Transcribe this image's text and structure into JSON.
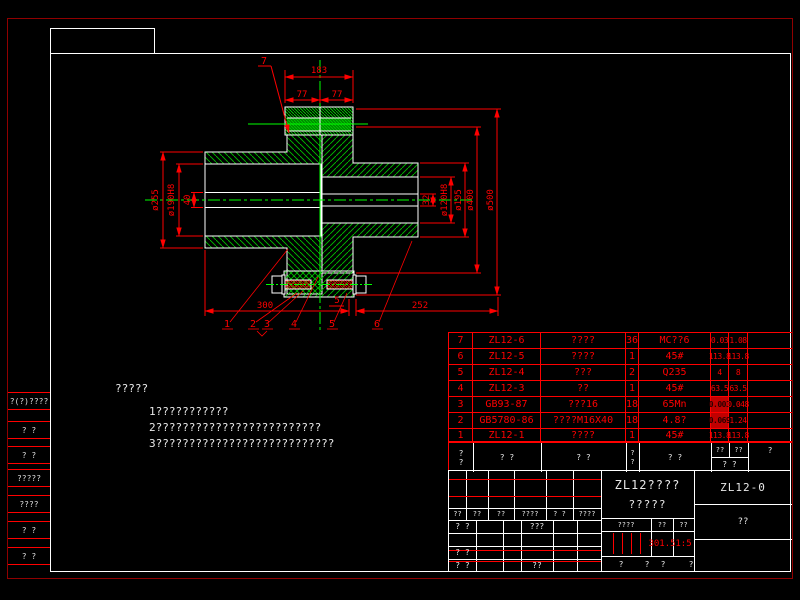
{
  "drawing": {
    "dims": {
      "overall_width": "183",
      "left_hub_len": "77",
      "right_hub_len": "77",
      "d255": "ø255",
      "d190": "ø190H8",
      "d40": "40",
      "d32": "32",
      "d120": "ø120H8",
      "d195": "ø195",
      "d400": "ø400",
      "d500": "ø500",
      "len_left": "300",
      "gap": "5",
      "len_right": "252"
    },
    "balloons": {
      "b1": "1",
      "b2": "2",
      "b3": "3",
      "b4": "4",
      "b5": "5",
      "b6": "6",
      "b7": "7"
    }
  },
  "notes": {
    "title": "?????",
    "line1": "1???????????",
    "line2": "2?????????????????????????",
    "line3": "3???????????????????????????"
  },
  "bom": {
    "header": {
      "no_top": "?",
      "no_bottom": "?",
      "code": "? ?",
      "name": "? ?",
      "qty_top": "?",
      "qty_bottom": "?",
      "material": "? ?",
      "unit": "??",
      "total": "??",
      "weight": "? ?",
      "remark": "?"
    },
    "rows": [
      {
        "no": "7",
        "code": "ZL12-6",
        "name": "????",
        "qty": "36",
        "material": "MC??6",
        "unit": "0.03",
        "total": "1.08"
      },
      {
        "no": "6",
        "code": "ZL12-5",
        "name": "????",
        "qty": "1",
        "material": "45#",
        "unit": "113.8",
        "total": "113.8"
      },
      {
        "no": "5",
        "code": "ZL12-4",
        "name": "???",
        "qty": "2",
        "material": "Q235",
        "unit": "4",
        "total": "8"
      },
      {
        "no": "4",
        "code": "ZL12-3",
        "name": "??",
        "qty": "1",
        "material": "45#",
        "unit": "63.5",
        "total": "63.5"
      },
      {
        "no": "3",
        "code": "GB93-87",
        "name": "???16",
        "qty": "18",
        "material": "65Mn",
        "unit": "0.003",
        "total": "0.048"
      },
      {
        "no": "2",
        "code": "GB5780-86",
        "name": "????M16X40",
        "qty": "18",
        "material": "4.8?",
        "unit": "0.069",
        "total": "1.24"
      },
      {
        "no": "1",
        "code": "ZL12-1",
        "name": "????",
        "qty": "1",
        "material": "45#",
        "unit": "113.8",
        "total": "113.8"
      }
    ]
  },
  "titleblock": {
    "rev_headers": [
      "??",
      "??",
      "??",
      "????",
      "? ?",
      "????"
    ],
    "sign_design": "? ?",
    "sign_standard": "???",
    "sign_check": "? ?",
    "sign_process": "? ?",
    "sign_approve": "??",
    "name_line1": "ZL12????",
    "name_line2": "?????",
    "stage_label": "????",
    "weight_label": "??",
    "scale_label": "??",
    "weight_value": "301.5",
    "scale_value": "1:5",
    "sheet_chars": [
      "?",
      "?",
      "?",
      "?"
    ],
    "drawing_no": "ZL12-0",
    "unit_name": "??"
  },
  "margin_strip": {
    "rows": [
      "?(?)????",
      "? ?",
      "? ?",
      "?????",
      "????",
      "? ?",
      "? ?"
    ]
  },
  "colors": {
    "line_red": "#ff0000",
    "border_dark_red": "#900000",
    "hatch_green": "#00c000",
    "centerline_green": "#00ff00",
    "grid_white": "#ffffff"
  }
}
